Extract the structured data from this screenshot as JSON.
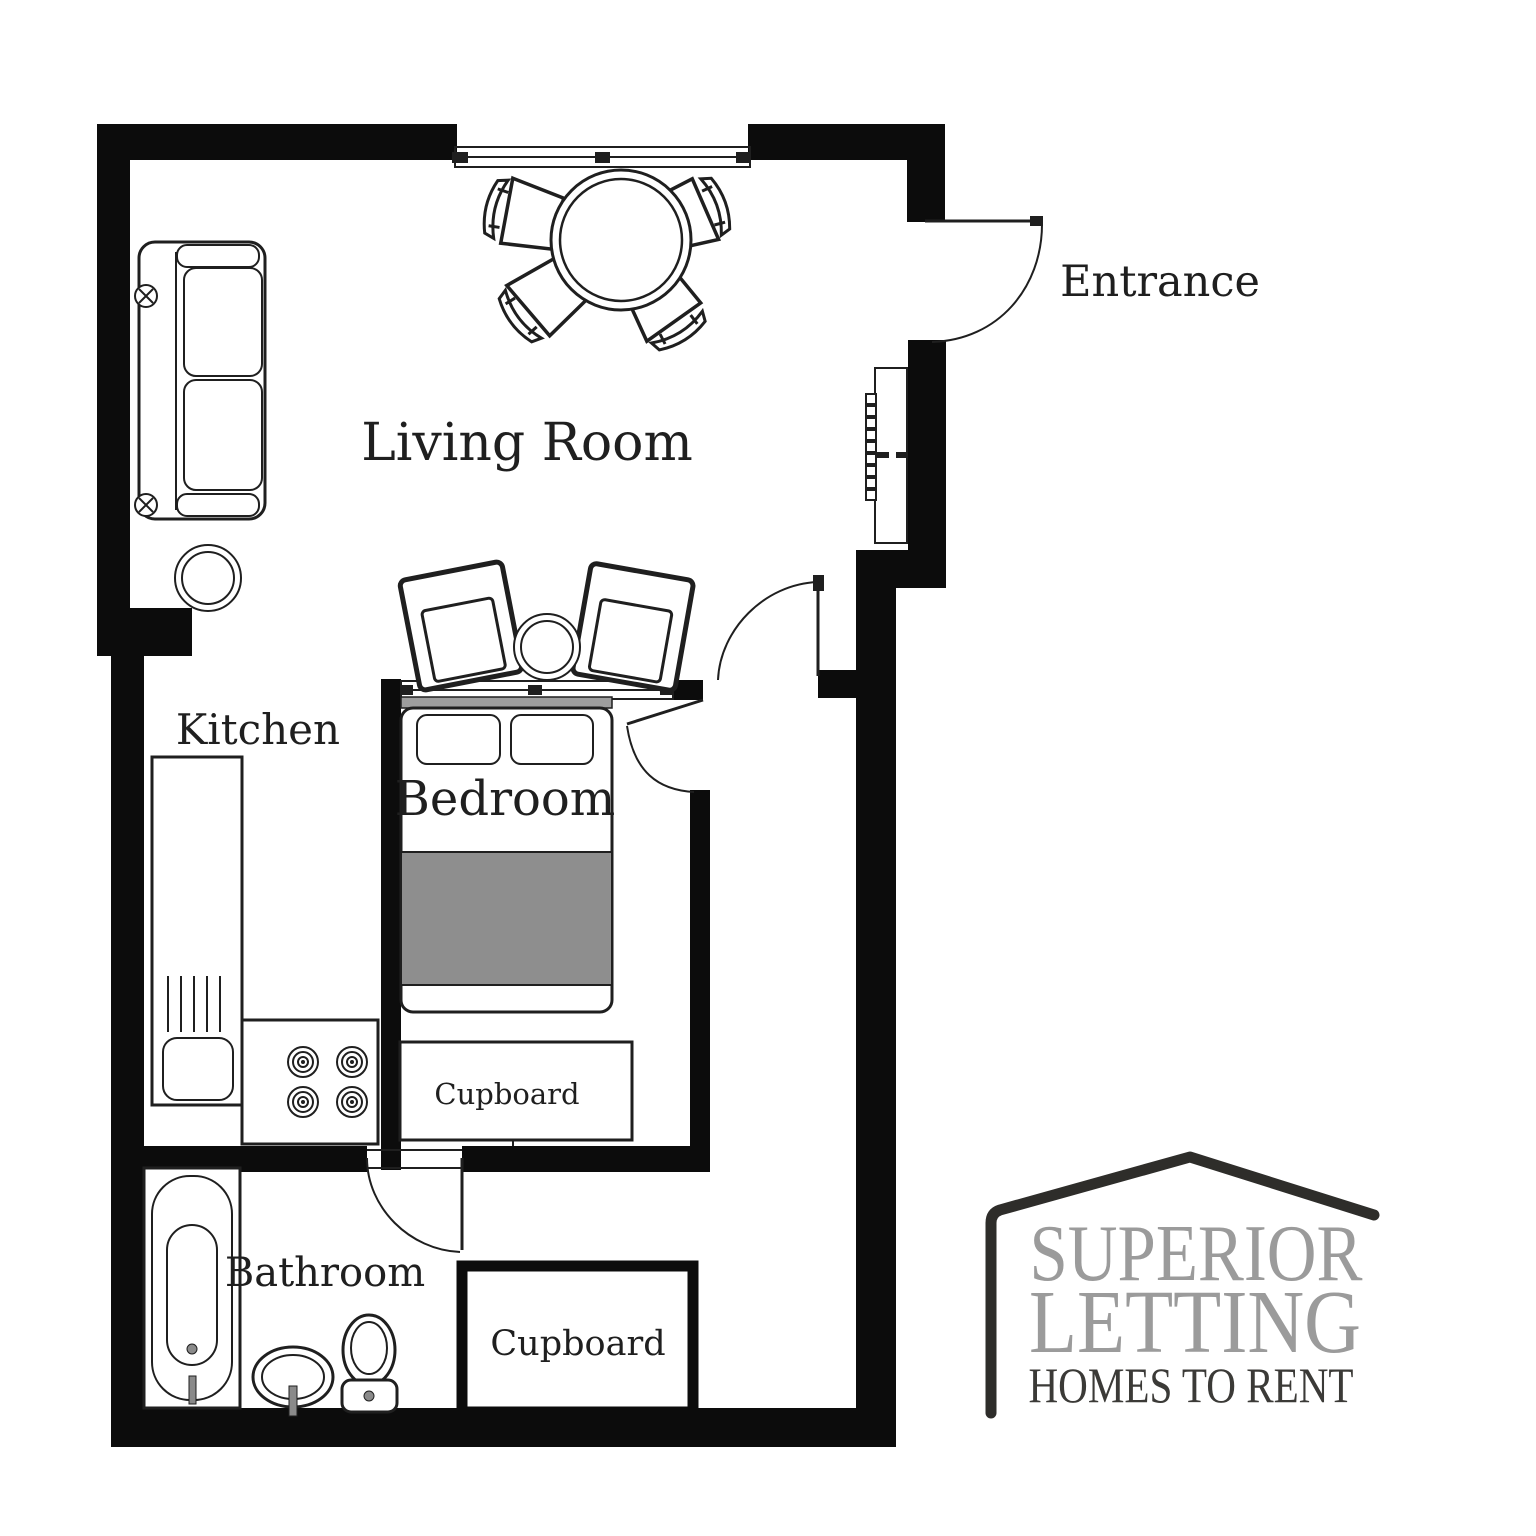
{
  "plan": {
    "rooms": {
      "living_room": "Living Room",
      "kitchen": "Kitchen",
      "bedroom": "Bedroom",
      "bathroom": "Bathroom"
    },
    "annotations": {
      "entrance": "Entrance",
      "bedroom_cupboard": "Cupboard",
      "bathroom_cupboard": "Cupboard"
    }
  },
  "logo": {
    "name_line1": "SUPERIOR",
    "name_line2": "LETTING",
    "tagline": "HOMES TO RENT"
  },
  "colors": {
    "wall": "#0c0c0c",
    "line": "#1f1f1f",
    "duvet": "#8e8e8e",
    "headboard": "#9e9e9e",
    "metal": "#8a8a8a",
    "logo_gray": "#9b9b9b",
    "logo_dark": "#3b3a37",
    "logo_roof": "#2e2d2a"
  }
}
